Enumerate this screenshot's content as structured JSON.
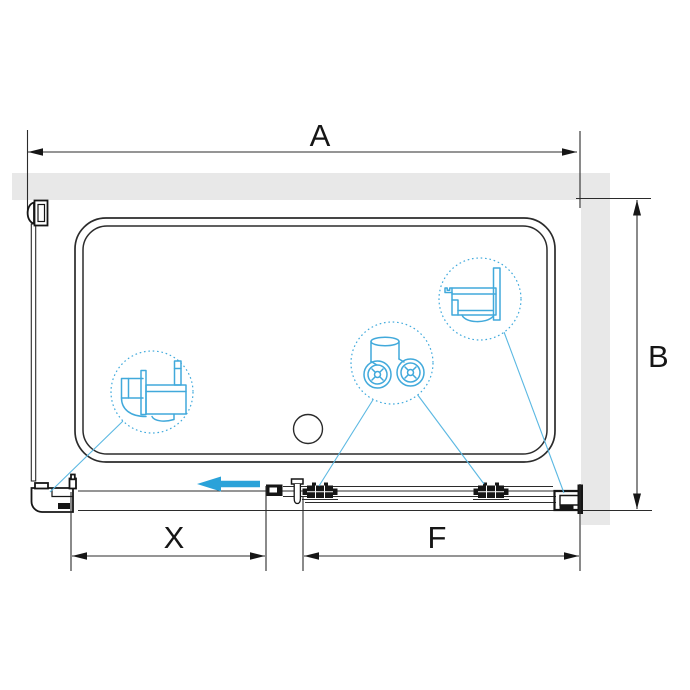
{
  "diagram": {
    "subject": "shower-enclosure-top-view-technical-drawing",
    "background": "#ffffff",
    "colors": {
      "line": "#2b2b2b",
      "profile_dark": "#161616",
      "wall_fill": "#e8e8e8",
      "accent_arrow": "#2aa2d9",
      "detail_cyan": "#41a9db"
    },
    "dimensions": [
      {
        "id": "A",
        "label": "A",
        "orientation": "horizontal",
        "position": "top"
      },
      {
        "id": "B",
        "label": "B",
        "orientation": "vertical",
        "position": "right"
      },
      {
        "id": "X",
        "label": "X",
        "orientation": "horizontal",
        "position": "bottom-left"
      },
      {
        "id": "F",
        "label": "F",
        "orientation": "horizontal",
        "position": "bottom-right"
      }
    ],
    "slide_arrow": {
      "direction": "left",
      "color": "#2aa2d9"
    },
    "callouts": [
      {
        "id": "wall-profile-detail",
        "shape": "dashed-circle",
        "content": "wall-profile-cross-section"
      },
      {
        "id": "roller-detail",
        "shape": "dashed-circle",
        "content": "double-roller-carriage"
      },
      {
        "id": "corner-profile-detail",
        "shape": "dashed-circle",
        "content": "end-profile-cross-section"
      }
    ]
  }
}
